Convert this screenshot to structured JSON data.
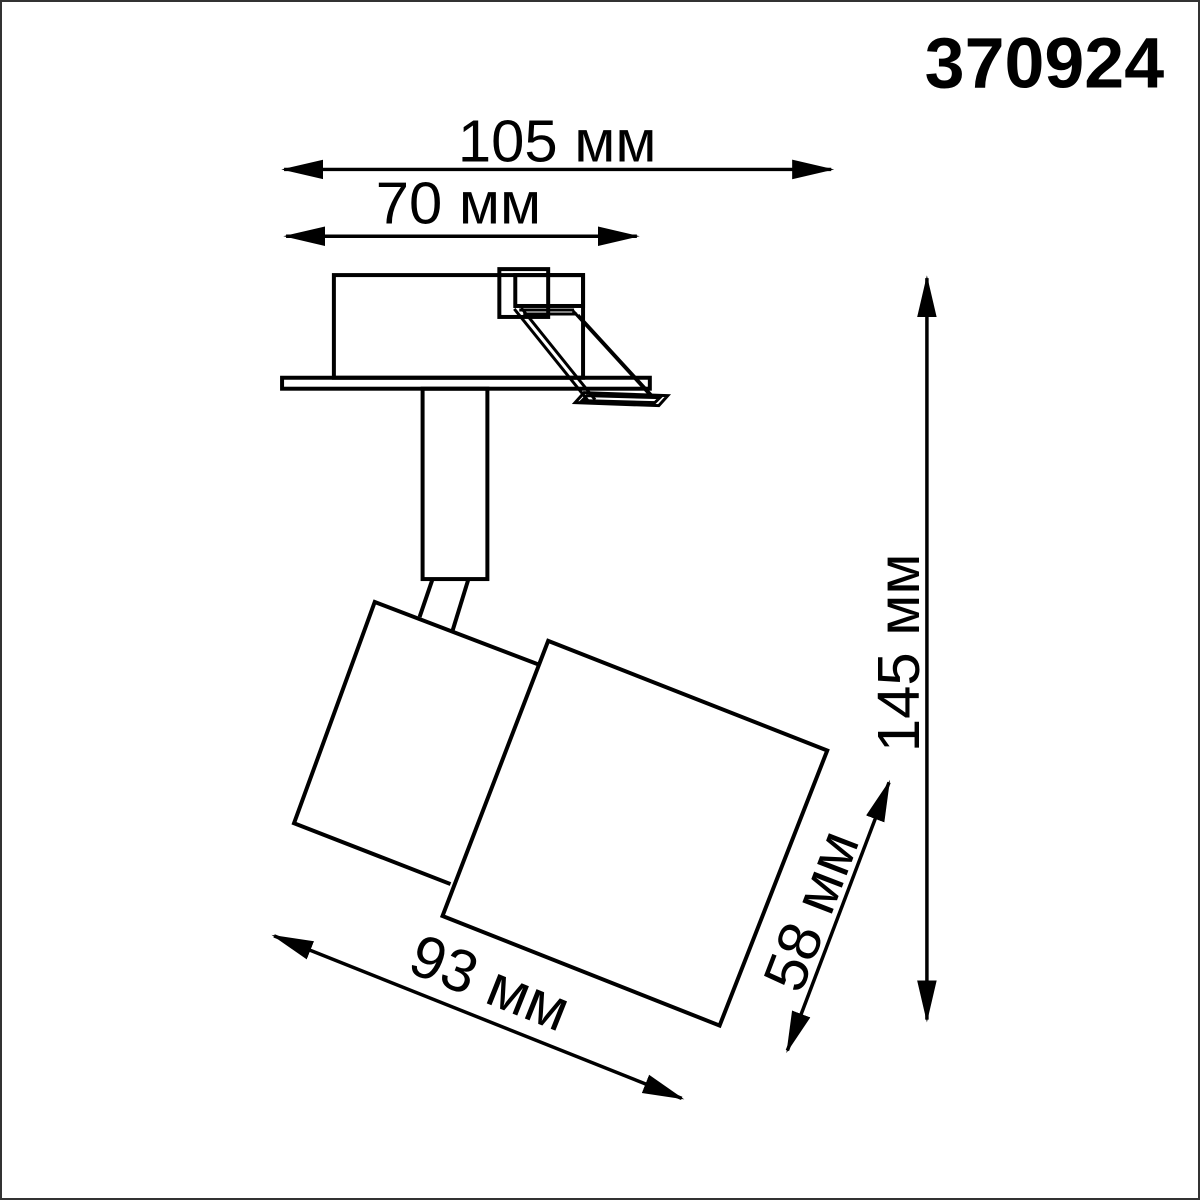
{
  "product": {
    "article": "370924"
  },
  "dimensions": {
    "overall_width": {
      "label": "105 мм",
      "value": 105,
      "unit": "мм"
    },
    "cutout_width": {
      "label": "70 мм",
      "value": 70,
      "unit": "мм"
    },
    "overall_height": {
      "label": "145 мм",
      "value": 145,
      "unit": "мм"
    },
    "head_length": {
      "label": "93 мм",
      "value": 93,
      "unit": "мм"
    },
    "head_width": {
      "label": "58 мм",
      "value": 58,
      "unit": "мм"
    }
  },
  "drawing": {
    "type": "technical-dimension-drawing",
    "subject": "recessed adjustable spot light fixture, side view",
    "parts": [
      "recessed housing",
      "spring clip",
      "mounting plate",
      "stem",
      "swivel joint",
      "spotlight head"
    ]
  },
  "colors": {
    "line": "#000000",
    "background": "#ffffff",
    "border": "#333333"
  }
}
